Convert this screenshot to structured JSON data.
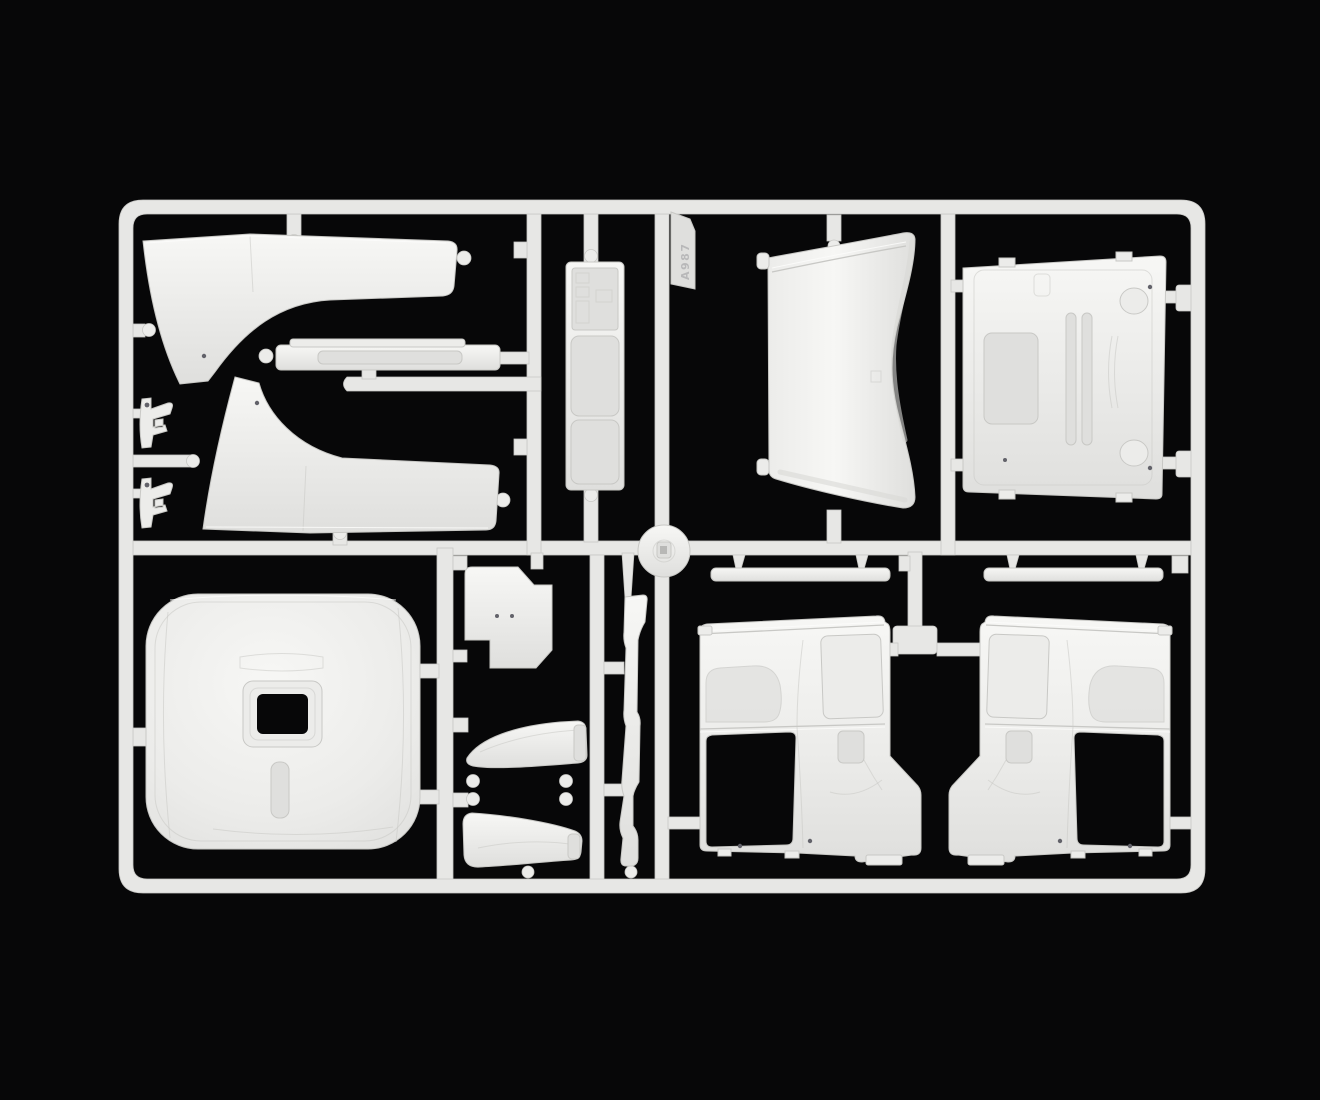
{
  "scene": {
    "type": "photograph",
    "subject": "White injection-molded plastic sprue (parts tree) of a truck model cab kit, photographed on a black background",
    "sprue_tag_text": "A987",
    "colors": {
      "bg": "#070708",
      "plastic": "#ececea",
      "plastic-hi": "#f7f7f5",
      "plastic-lo": "#dfdfdd",
      "runner": "#e7e7e5",
      "line": "#c8c8c5",
      "highlight": "#fcfcfa",
      "shade": "#d8d8d5",
      "dot": "#62626a"
    }
  },
  "parts": [
    {
      "name": "sprue-frame",
      "label": "outer runner frame"
    },
    {
      "name": "fender-panel-upper",
      "label": "cab step / fender panel (upper)"
    },
    {
      "name": "fender-panel-lower",
      "label": "cab step / fender panel (lower, mirrored)"
    },
    {
      "name": "mounting-bracket-1",
      "label": "small mounting bracket"
    },
    {
      "name": "mounting-bracket-2",
      "label": "small mounting bracket"
    },
    {
      "name": "visor-strip",
      "label": "long sun-visor strip"
    },
    {
      "name": "interior-panel",
      "label": "narrow interior panel with molded detail"
    },
    {
      "name": "sprue-tag",
      "label": "embossed part-number tag on runner"
    },
    {
      "name": "roof-deflector",
      "label": "curved roof air-deflector panel"
    },
    {
      "name": "cab-back-panel",
      "label": "cab rear wall panel with recesses and hinge domes"
    },
    {
      "name": "hub-disc",
      "label": "round hub disc on runner junction"
    },
    {
      "name": "cab-roof-panel",
      "label": "large cab roof panel with sunroof opening"
    },
    {
      "name": "floor-plate",
      "label": "small notched floor plate"
    },
    {
      "name": "corner-deflector-upper",
      "label": "curved corner deflector scoop"
    },
    {
      "name": "corner-deflector-lower",
      "label": "curved corner deflector scoop"
    },
    {
      "name": "side-trim-strip",
      "label": "tall narrow side trim strip"
    },
    {
      "name": "window-sill-strip-left",
      "label": "window sill strip"
    },
    {
      "name": "window-sill-strip-right",
      "label": "window sill strip"
    },
    {
      "name": "cab-side-panel-left",
      "label": "cab side panel with door window cutout"
    },
    {
      "name": "cab-side-panel-right",
      "label": "cab side panel, mirror image"
    }
  ]
}
